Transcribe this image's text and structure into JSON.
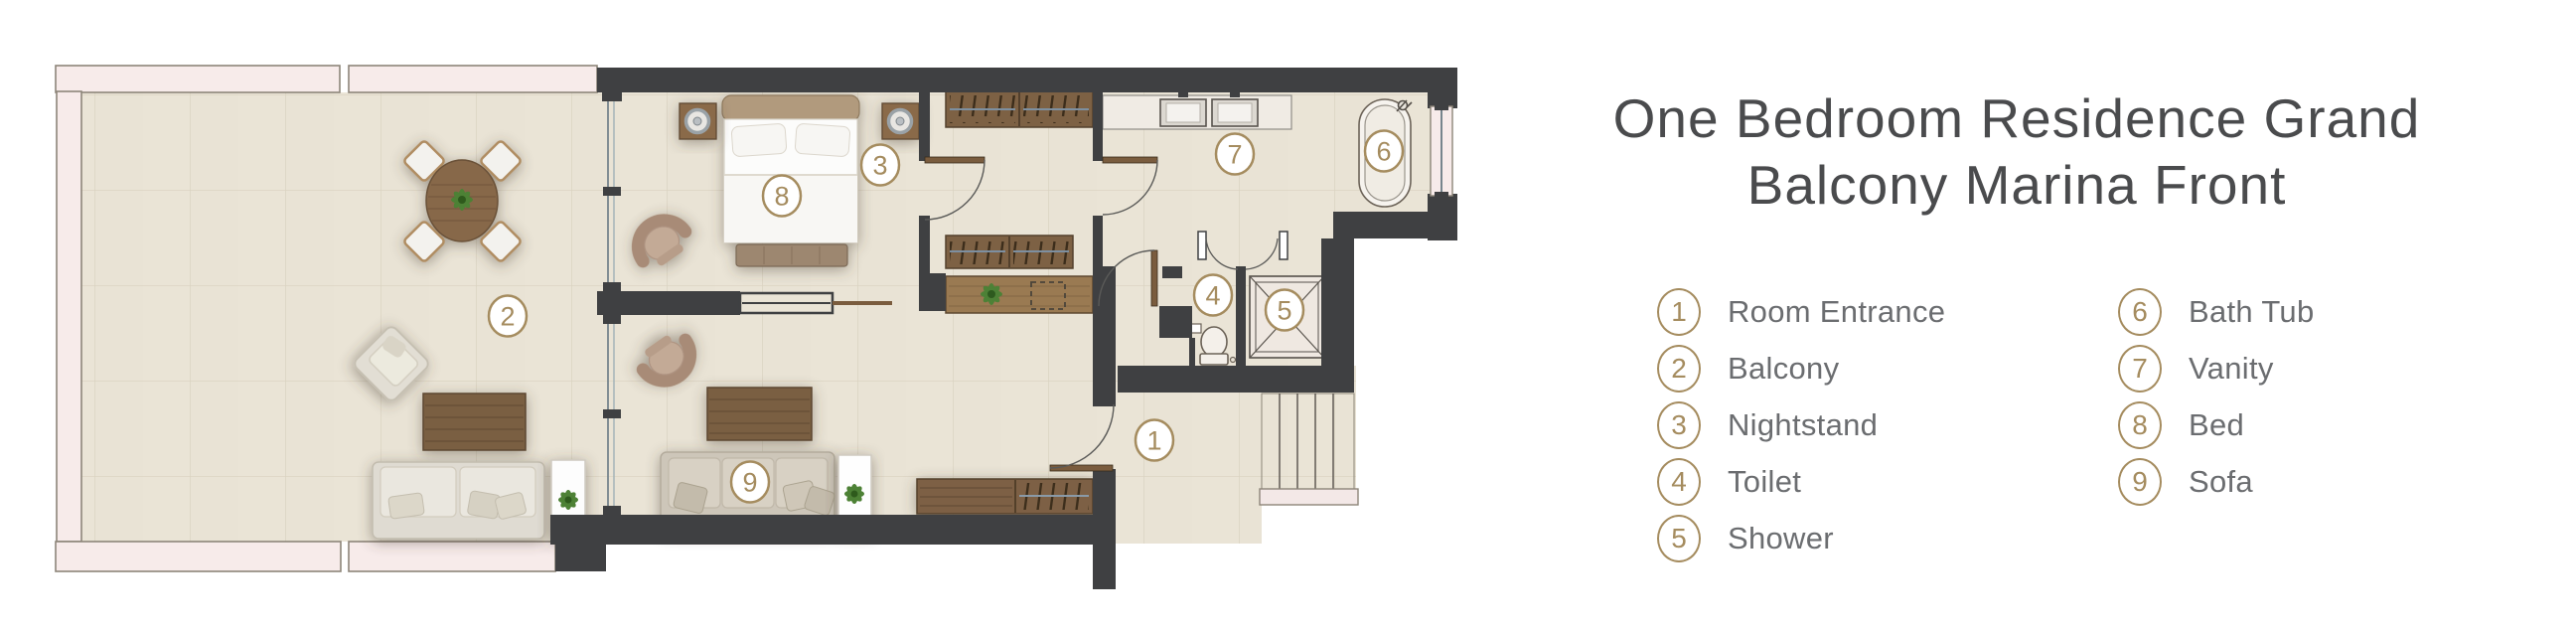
{
  "title": {
    "line1": "One Bedroom Residence Grand",
    "line2": "Balcony Marina Front"
  },
  "legend": {
    "col1": [
      {
        "num": "1",
        "label": "Room Entrance"
      },
      {
        "num": "2",
        "label": "Balcony"
      },
      {
        "num": "3",
        "label": "Nightstand"
      },
      {
        "num": "4",
        "label": "Toilet"
      },
      {
        "num": "5",
        "label": "Shower"
      }
    ],
    "col2": [
      {
        "num": "6",
        "label": "Bath Tub"
      },
      {
        "num": "7",
        "label": "Vanity"
      },
      {
        "num": "8",
        "label": "Bed"
      },
      {
        "num": "9",
        "label": "Sofa"
      }
    ]
  },
  "floorplan": {
    "markers": [
      {
        "num": "1",
        "label": "Room Entrance",
        "pos": "translate(1162,443)"
      },
      {
        "num": "2",
        "label": "Balcony",
        "pos": "translate(511,318)"
      },
      {
        "num": "3",
        "label": "Nightstand",
        "pos": "translate(886,166)"
      },
      {
        "num": "4",
        "label": "Toilet",
        "pos": "translate(1221,297)"
      },
      {
        "num": "5",
        "label": "Shower",
        "pos": "translate(1293,312)"
      },
      {
        "num": "6",
        "label": "Bath Tub",
        "pos": "translate(1393,152)"
      },
      {
        "num": "7",
        "label": "Vanity",
        "pos": "translate(1243,155)"
      },
      {
        "num": "8",
        "label": "Bed",
        "pos": "translate(787,197)"
      },
      {
        "num": "9",
        "label": "Sofa",
        "pos": "translate(755,485)"
      }
    ]
  },
  "colors": {
    "accent_gold": "#a58c5f",
    "label_gray": "#6b6d70",
    "title_gray": "#4a4b4d",
    "wall_dark": "#3f4042",
    "railing_pink": "#f7ebea",
    "floor_beige": "#eae4d6"
  }
}
